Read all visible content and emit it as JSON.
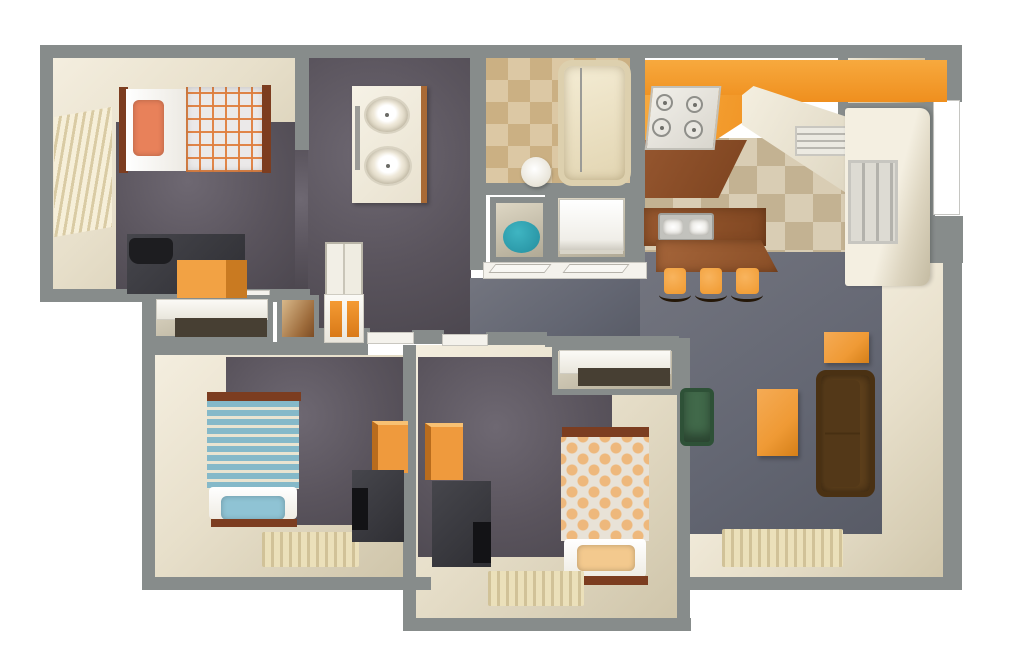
{
  "canvas": {
    "w": 1024,
    "h": 662,
    "background": "#ffffff"
  },
  "plan": {
    "kind": "apartment-3d-floor-plan",
    "rooms": [
      "bedroom-1",
      "master-bathroom",
      "bathroom-2",
      "laundry-closet",
      "water-heater-closet",
      "kitchen",
      "dining-nook",
      "entry-closet",
      "hallway",
      "bedroom-2",
      "bedroom-3",
      "living-room"
    ]
  },
  "palette": {
    "wall": "#878c8b",
    "carpet": "#e7dfca",
    "floor_dark": "#5a545d",
    "floor_slate": "#666a74",
    "kitchen_tile_a": "#d9cdb4",
    "kitchen_tile_b": "#c3b292",
    "bath_tile_a": "#dcc8a4",
    "bath_tile_b": "#cbb083",
    "counter_orange": "#f39b2e",
    "counter_brown": "#8c4e2a",
    "furniture_orange": "#ef9a3d",
    "sofa_brown": "#5d3f1b",
    "chair_green": "#41694a",
    "water_heater_teal": "#2b9dad",
    "bed1_pillow": "#e8815a",
    "bed2_stripe": "#85b9c9",
    "bed2_pillow": "#8fc3d4",
    "bed3_dot": "#eeb87c",
    "bed3_pillow": "#f3c98e",
    "bed_wood": "#7c3d20",
    "charcoal": "#3a393d"
  },
  "items": [
    {
      "n": "bedroom1-carpet",
      "c": "room-carpet",
      "x": 52,
      "y": 58,
      "w": 244,
      "h": 234
    },
    {
      "n": "bedroom1-floor",
      "c": "floor-dark",
      "x": 116,
      "y": 122,
      "w": 179,
      "h": 170
    },
    {
      "n": "bedroom1-doorway-floor",
      "c": "floor-dark",
      "x": 295,
      "y": 150,
      "w": 14,
      "h": 142
    },
    {
      "n": "master-bath-floor",
      "c": "floor-dark",
      "x": 308,
      "y": 58,
      "w": 163,
      "h": 277
    },
    {
      "n": "hallway-floor",
      "c": "floor-slate",
      "x": 470,
      "y": 278,
      "w": 178,
      "h": 60
    },
    {
      "n": "bathroom2-floor",
      "c": "tile-bath",
      "x": 486,
      "y": 58,
      "w": 146,
      "h": 130
    },
    {
      "n": "kitchen-floor",
      "c": "tile-kitchen",
      "x": 645,
      "y": 138,
      "w": 235,
      "h": 130
    },
    {
      "n": "dining-nook-carpet",
      "c": "room-carpet",
      "x": 880,
      "y": 228,
      "w": 64,
      "h": 350
    },
    {
      "n": "living-room-carpet",
      "c": "room-carpet",
      "x": 645,
      "y": 530,
      "w": 299,
      "h": 48
    },
    {
      "n": "living-room-floor",
      "c": "floor-slate",
      "x": 640,
      "y": 252,
      "w": 242,
      "h": 282
    },
    {
      "n": "bedroom2-carpet",
      "c": "room-carpet",
      "x": 155,
      "y": 355,
      "w": 249,
      "h": 223
    },
    {
      "n": "bedroom2-floor",
      "c": "floor-dark",
      "x": 226,
      "y": 357,
      "w": 178,
      "h": 168
    },
    {
      "n": "bedroom3-carpet",
      "c": "room-carpet",
      "x": 416,
      "y": 345,
      "w": 262,
      "h": 273
    },
    {
      "n": "bedroom3-floor",
      "c": "floor-dark",
      "x": 418,
      "y": 357,
      "w": 194,
      "h": 200
    },
    {
      "n": "entry-closet-floor",
      "c": "closet-int",
      "x": 848,
      "y": 58,
      "w": 77,
      "h": 45
    },
    {
      "n": "water-heater-closet",
      "c": "closet-box",
      "x": 490,
      "y": 197,
      "w": 59,
      "h": 66
    },
    {
      "n": "laundry-closet",
      "c": "closet-box",
      "x": 552,
      "y": 192,
      "w": 79,
      "h": 71
    },
    {
      "n": "top-wall",
      "c": "wall",
      "x": 40,
      "y": 45,
      "w": 890,
      "h": 13
    },
    {
      "n": "west-wall-upper",
      "c": "wall",
      "x": 40,
      "y": 45,
      "w": 13,
      "h": 257
    },
    {
      "n": "bedroom1-south-wall",
      "c": "wall",
      "x": 40,
      "y": 289,
      "w": 270,
      "h": 13
    },
    {
      "n": "west-wall-lower",
      "c": "wall",
      "x": 142,
      "y": 289,
      "w": 13,
      "h": 301
    },
    {
      "n": "bedroom2-south-wall",
      "c": "wall",
      "x": 142,
      "y": 577,
      "w": 289,
      "h": 13
    },
    {
      "n": "bedroom3-west-wall",
      "c": "wall",
      "x": 403,
      "y": 345,
      "w": 13,
      "h": 286
    },
    {
      "n": "bedroom3-south-wall",
      "c": "wall",
      "x": 403,
      "y": 618,
      "w": 288,
      "h": 13
    },
    {
      "n": "bedroom3-east-wall",
      "c": "wall",
      "x": 677,
      "y": 338,
      "w": 13,
      "h": 293
    },
    {
      "n": "living-south-wall",
      "c": "wall",
      "x": 677,
      "y": 577,
      "w": 285,
      "h": 13
    },
    {
      "n": "living-east-wall",
      "c": "wall",
      "x": 943,
      "y": 250,
      "w": 19,
      "h": 340
    },
    {
      "n": "northeast-wall-top",
      "c": "wall",
      "x": 925,
      "y": 45,
      "w": 37,
      "h": 57
    },
    {
      "n": "northeast-wall-strip",
      "c": "wall",
      "x": 925,
      "y": 100,
      "w": 10,
      "h": 118
    },
    {
      "n": "northeast-wall-mid",
      "c": "wall",
      "x": 925,
      "y": 216,
      "w": 38,
      "h": 47
    },
    {
      "n": "bedroom1-east-wall",
      "c": "wall",
      "x": 295,
      "y": 45,
      "w": 14,
      "h": 105
    },
    {
      "n": "bathroom-divider-wall",
      "c": "wall",
      "x": 470,
      "y": 45,
      "w": 16,
      "h": 225
    },
    {
      "n": "kitchen-west-wall",
      "c": "wall",
      "x": 630,
      "y": 45,
      "w": 15,
      "h": 225
    },
    {
      "n": "bathroom2-south-wall",
      "c": "wall",
      "x": 470,
      "y": 183,
      "w": 178,
      "h": 12
    },
    {
      "n": "closet-divider-wall",
      "c": "wall",
      "x": 545,
      "y": 190,
      "w": 10,
      "h": 80
    },
    {
      "n": "entry-closet-west-wall",
      "c": "wall",
      "x": 838,
      "y": 58,
      "w": 10,
      "h": 60
    },
    {
      "n": "entry-closet-south-wall",
      "c": "wall",
      "x": 838,
      "y": 103,
      "w": 92,
      "h": 13
    },
    {
      "n": "hall-south-wall-a",
      "c": "wall",
      "x": 308,
      "y": 328,
      "w": 62,
      "h": 15
    },
    {
      "n": "hall-south-wall-b",
      "c": "wall",
      "x": 412,
      "y": 330,
      "w": 32,
      "h": 14
    },
    {
      "n": "hall-south-wall-c",
      "c": "wall",
      "x": 486,
      "y": 332,
      "w": 61,
      "h": 13
    },
    {
      "n": "bedroom3-closet-north-wall",
      "c": "wall",
      "x": 545,
      "y": 336,
      "w": 134,
      "h": 11
    },
    {
      "n": "bedroom2-north-wall",
      "c": "wall",
      "x": 155,
      "y": 342,
      "w": 213,
      "h": 13
    },
    {
      "n": "front-door",
      "c": "door-white",
      "x": 933,
      "y": 100,
      "w": 27,
      "h": 115
    },
    {
      "n": "bedroom1-door-threshold",
      "c": "threshold",
      "x": 215,
      "y": 291,
      "w": 54,
      "h": 10
    },
    {
      "n": "bedroom2-door-threshold",
      "c": "threshold",
      "x": 368,
      "y": 333,
      "w": 45,
      "h": 10
    },
    {
      "n": "bedroom3-door-threshold",
      "c": "threshold",
      "x": 443,
      "y": 335,
      "w": 44,
      "h": 10
    },
    {
      "n": "closet-threshold",
      "c": "threshold",
      "x": 484,
      "y": 263,
      "w": 162,
      "h": 15
    },
    {
      "n": "closet-door-leaf-left",
      "c": "door-leaf",
      "x": 492,
      "y": 264,
      "w": 56,
      "h": 9
    },
    {
      "n": "closet-door-leaf-right",
      "c": "door-leaf",
      "x": 566,
      "y": 264,
      "w": 60,
      "h": 9
    },
    {
      "n": "bedroom1-closet",
      "c": "closet-box",
      "x": 150,
      "y": 295,
      "w": 123,
      "h": 47
    },
    {
      "n": "bedroom1-closet-shelf",
      "c": "shelf-white",
      "x": 157,
      "y": 300,
      "w": 110,
      "h": 19
    },
    {
      "n": "bedroom1-closet-gap",
      "c": "shelf-gap",
      "x": 175,
      "y": 318,
      "w": 92,
      "h": 19
    },
    {
      "n": "hall-storage-closet",
      "c": "closet-brown",
      "x": 277,
      "y": 295,
      "w": 42,
      "h": 47
    },
    {
      "n": "hall-cabinet",
      "c": "cabinet-doors",
      "x": 325,
      "y": 242,
      "w": 38,
      "h": 54
    },
    {
      "n": "hall-bookshelf",
      "c": "shelf-white",
      "x": 325,
      "y": 295,
      "w": 38,
      "h": 47
    },
    {
      "n": "bookshelf-cubby-left",
      "c": "cubby",
      "x": 330,
      "y": 301,
      "w": 12,
      "h": 36
    },
    {
      "n": "bookshelf-cubby-right",
      "c": "cubby",
      "x": 347,
      "y": 301,
      "w": 12,
      "h": 36
    },
    {
      "n": "bedroom3-closet",
      "c": "closet-box",
      "x": 552,
      "y": 345,
      "w": 126,
      "h": 50
    },
    {
      "n": "bedroom3-closet-shelf",
      "c": "shelf-white",
      "x": 560,
      "y": 351,
      "w": 110,
      "h": 22
    },
    {
      "n": "bedroom3-closet-gap",
      "c": "shelf-gap",
      "x": 578,
      "y": 368,
      "w": 92,
      "h": 18
    },
    {
      "n": "double-vanity",
      "c": "vanity",
      "x": 352,
      "y": 86,
      "w": 75,
      "h": 117
    },
    {
      "n": "vanity-sink-top",
      "c": "sink-oval",
      "x": 364,
      "y": 96,
      "w": 46,
      "h": 38
    },
    {
      "n": "vanity-sink-bottom",
      "c": "sink-oval",
      "x": 364,
      "y": 146,
      "w": 48,
      "h": 40
    },
    {
      "n": "vanity-faucet",
      "c": "faucet",
      "x": 355,
      "y": 106,
      "w": 5,
      "h": 64
    },
    {
      "n": "bathtub",
      "c": "tub",
      "x": 558,
      "y": 60,
      "w": 73,
      "h": 126
    },
    {
      "n": "shower-divider",
      "c": "faucet",
      "x": 580,
      "y": 68,
      "w": 2,
      "h": 104
    },
    {
      "n": "toilet",
      "c": "toilet",
      "x": 521,
      "y": 157,
      "w": 30,
      "h": 30
    },
    {
      "n": "water-heater",
      "c": "circle-teal",
      "x": 503,
      "y": 221,
      "w": 37,
      "h": 32
    },
    {
      "n": "washer-dryer",
      "c": "washer",
      "x": 560,
      "y": 200,
      "w": 63,
      "h": 50
    },
    {
      "n": "kitchen-counter-orange",
      "c": "counter-orange",
      "x": 645,
      "y": 60,
      "w": 302,
      "h": 42
    },
    {
      "n": "kitchen-counter-orange-wing",
      "c": "counter-orange-wing",
      "x": 645,
      "y": 95,
      "w": 140,
      "h": 50
    },
    {
      "n": "kitchen-counter-brown",
      "c": "counter-brown",
      "x": 645,
      "y": 140,
      "w": 102,
      "h": 58
    },
    {
      "n": "kitchen-counter-white",
      "c": "slab-white",
      "x": 742,
      "y": 86,
      "w": 115,
      "h": 114
    },
    {
      "n": "stove",
      "c": "stove",
      "x": 648,
      "y": 86,
      "w": 70,
      "h": 64
    },
    {
      "n": "burner-1",
      "c": "burner",
      "x": 656,
      "y": 94,
      "w": 17,
      "h": 17
    },
    {
      "n": "burner-2",
      "c": "burner",
      "x": 686,
      "y": 96,
      "w": 17,
      "h": 17
    },
    {
      "n": "burner-3",
      "c": "burner",
      "x": 652,
      "y": 118,
      "w": 19,
      "h": 19
    },
    {
      "n": "burner-4",
      "c": "burner",
      "x": 684,
      "y": 120,
      "w": 19,
      "h": 19
    },
    {
      "n": "dishwasher",
      "c": "dishwasher",
      "x": 795,
      "y": 126,
      "w": 64,
      "h": 30
    },
    {
      "n": "refrigerator",
      "c": "fridge",
      "x": 845,
      "y": 108,
      "w": 85,
      "h": 178
    },
    {
      "n": "kitchen-window",
      "c": "window-frame",
      "x": 848,
      "y": 160,
      "w": 50,
      "h": 84
    },
    {
      "n": "kitchen-island",
      "c": "island",
      "x": 644,
      "y": 208,
      "w": 122,
      "h": 38
    },
    {
      "n": "island-sink",
      "c": "sink-double",
      "x": 658,
      "y": 213,
      "w": 56,
      "h": 28
    },
    {
      "n": "breakfast-bar",
      "c": "island-bar",
      "x": 656,
      "y": 240,
      "w": 122,
      "h": 32
    },
    {
      "n": "bar-stool-1",
      "c": "stool",
      "x": 664,
      "y": 268,
      "w": 22,
      "h": 26
    },
    {
      "n": "bar-stool-2",
      "c": "stool",
      "x": 700,
      "y": 268,
      "w": 22,
      "h": 26
    },
    {
      "n": "bar-stool-3",
      "c": "stool",
      "x": 736,
      "y": 268,
      "w": 23,
      "h": 26
    },
    {
      "n": "stool-legs-1",
      "c": "stool-legs",
      "x": 659,
      "y": 288,
      "w": 32,
      "h": 14
    },
    {
      "n": "stool-legs-2",
      "c": "stool-legs",
      "x": 695,
      "y": 288,
      "w": 32,
      "h": 14
    },
    {
      "n": "stool-legs-3",
      "c": "stool-legs",
      "x": 731,
      "y": 288,
      "w": 32,
      "h": 14
    },
    {
      "n": "end-table",
      "c": "table-orange",
      "x": 824,
      "y": 332,
      "w": 45,
      "h": 31
    },
    {
      "n": "sofa",
      "c": "couch",
      "x": 816,
      "y": 370,
      "w": 59,
      "h": 127
    },
    {
      "n": "coffee-table",
      "c": "table-orange",
      "x": 757,
      "y": 389,
      "w": 41,
      "h": 67
    },
    {
      "n": "armchair",
      "c": "chair-green",
      "x": 680,
      "y": 388,
      "w": 34,
      "h": 58
    },
    {
      "n": "living-room-rug",
      "c": "rug",
      "x": 722,
      "y": 529,
      "w": 121,
      "h": 38
    },
    {
      "n": "bedroom1-window",
      "c": "blinds",
      "x": 54,
      "y": 112,
      "w": 58,
      "h": 120
    },
    {
      "n": "bed1-headboard",
      "c": "wood",
      "x": 119,
      "y": 87,
      "w": 9,
      "h": 86
    },
    {
      "n": "bed1-sheet",
      "c": "white-sheet",
      "x": 126,
      "y": 89,
      "w": 62,
      "h": 82
    },
    {
      "n": "bed1-pillow",
      "c": "pillow",
      "x": 133,
      "y": 100,
      "w": 31,
      "h": 56,
      "bg": "#e8815a"
    },
    {
      "n": "bed1-plaid-blanket",
      "c": "plaid",
      "x": 186,
      "y": 87,
      "w": 78,
      "h": 85
    },
    {
      "n": "bed1-footboard",
      "c": "wood",
      "x": 262,
      "y": 85,
      "w": 9,
      "h": 88
    },
    {
      "n": "desk",
      "c": "charcoal",
      "x": 127,
      "y": 234,
      "w": 118,
      "h": 60
    },
    {
      "n": "desk-chair",
      "c": "desk-chair",
      "x": 129,
      "y": 238,
      "w": 44,
      "h": 26
    },
    {
      "n": "file-cabinet",
      "c": "cabinet-orange",
      "x": 177,
      "y": 260,
      "w": 70,
      "h": 38
    },
    {
      "n": "bed2-headboard",
      "c": "wood",
      "x": 207,
      "y": 392,
      "w": 94,
      "h": 9
    },
    {
      "n": "bed2-striped-blanket",
      "c": "stripes-blue",
      "x": 207,
      "y": 401,
      "w": 92,
      "h": 88
    },
    {
      "n": "bed2-mattress",
      "c": "mattress",
      "x": 209,
      "y": 487,
      "w": 88,
      "h": 32
    },
    {
      "n": "bed2-pillow",
      "c": "pillow",
      "x": 221,
      "y": 496,
      "w": 64,
      "h": 24,
      "bg": "#8fc3d4"
    },
    {
      "n": "bed2-footboard",
      "c": "wood",
      "x": 211,
      "y": 519,
      "w": 86,
      "h": 8
    },
    {
      "n": "bedroom2-rug",
      "c": "rug",
      "x": 262,
      "y": 532,
      "w": 97,
      "h": 35
    },
    {
      "n": "bedroom2-wardrobe",
      "c": "wardrobe",
      "x": 372,
      "y": 421,
      "w": 36,
      "h": 52
    },
    {
      "n": "bedroom2-dresser",
      "c": "charcoal",
      "x": 352,
      "y": 470,
      "w": 52,
      "h": 72
    },
    {
      "n": "bedroom2-tv",
      "c": "tv",
      "x": 352,
      "y": 488,
      "w": 16,
      "h": 42
    },
    {
      "n": "bedroom3-wardrobe",
      "c": "wardrobe",
      "x": 425,
      "y": 423,
      "w": 38,
      "h": 57
    },
    {
      "n": "bedroom3-dresser",
      "c": "charcoal",
      "x": 432,
      "y": 481,
      "w": 59,
      "h": 86
    },
    {
      "n": "bedroom3-tv",
      "c": "tv",
      "x": 473,
      "y": 522,
      "w": 18,
      "h": 41
    },
    {
      "n": "bed3-headboard",
      "c": "wood",
      "x": 562,
      "y": 427,
      "w": 87,
      "h": 10
    },
    {
      "n": "bed3-dotted-blanket",
      "c": "dots",
      "x": 561,
      "y": 437,
      "w": 88,
      "h": 104
    },
    {
      "n": "bed3-mattress",
      "c": "mattress",
      "x": 564,
      "y": 539,
      "w": 82,
      "h": 38
    },
    {
      "n": "bed3-pillow",
      "c": "pillow",
      "x": 577,
      "y": 545,
      "w": 58,
      "h": 26,
      "bg": "#f3c98e"
    },
    {
      "n": "bed3-footboard",
      "c": "wood",
      "x": 563,
      "y": 576,
      "w": 85,
      "h": 9
    },
    {
      "n": "bedroom3-rug",
      "c": "rug",
      "x": 488,
      "y": 571,
      "w": 96,
      "h": 35
    }
  ]
}
